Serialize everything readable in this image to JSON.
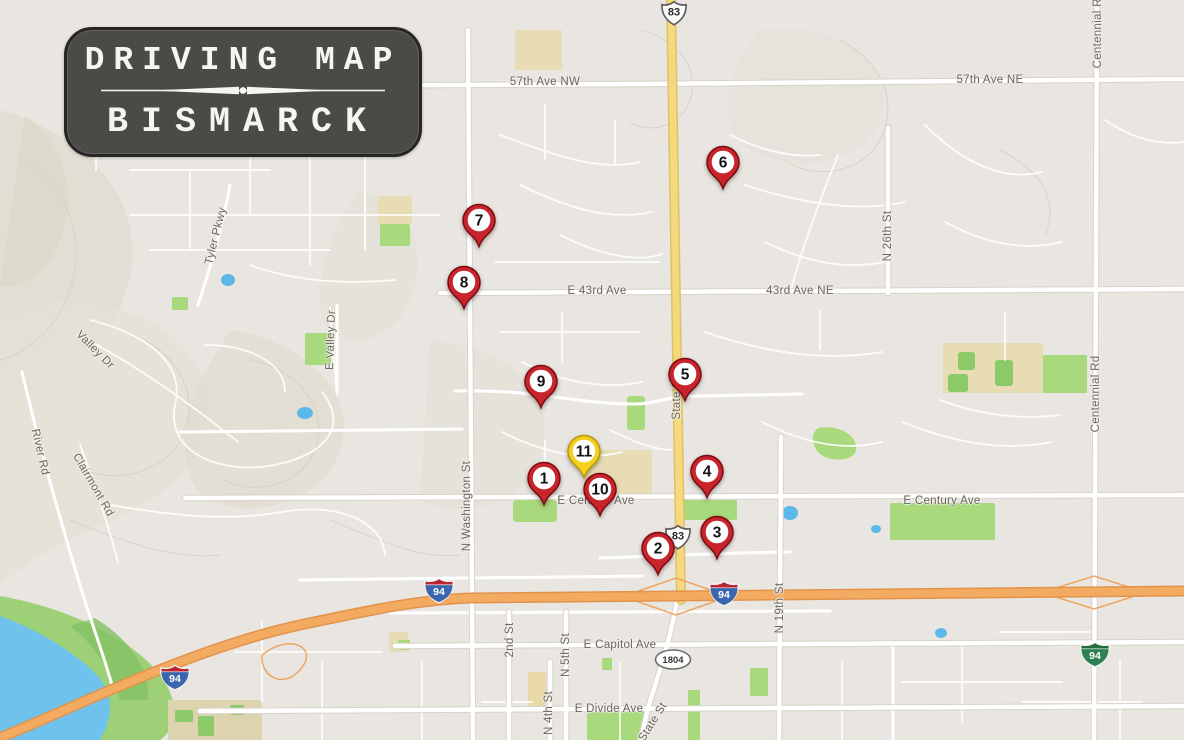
{
  "title_badge": {
    "line1": "DRIVING MAP",
    "line2": "BISMARCK"
  },
  "colors": {
    "background": "#e9e6e1",
    "marker_red": "#c8242c",
    "marker_red_border": "#7d0c12",
    "marker_yellow": "#f3cf1e",
    "marker_yellow_border": "#b8990a",
    "highway_orange": "#f3aa61",
    "route_yellow": "#f6d87d",
    "park_green": "#a8d97c",
    "field_green": "#8cc968",
    "campus_beige": "#e7dcb4",
    "water_blue": "#6ec2ec",
    "road_white": "#ffffff",
    "label_gray": "#6a655e"
  },
  "markers": [
    {
      "number": "1",
      "x": 544,
      "y": 478,
      "variant": "red"
    },
    {
      "number": "2",
      "x": 658,
      "y": 548,
      "variant": "red"
    },
    {
      "number": "3",
      "x": 717,
      "y": 532,
      "variant": "red"
    },
    {
      "number": "4",
      "x": 707,
      "y": 471,
      "variant": "red"
    },
    {
      "number": "5",
      "x": 685,
      "y": 374,
      "variant": "red"
    },
    {
      "number": "6",
      "x": 723,
      "y": 162,
      "variant": "red"
    },
    {
      "number": "7",
      "x": 479,
      "y": 220,
      "variant": "red"
    },
    {
      "number": "8",
      "x": 464,
      "y": 282,
      "variant": "red"
    },
    {
      "number": "9",
      "x": 541,
      "y": 381,
      "variant": "red"
    },
    {
      "number": "10",
      "x": 600,
      "y": 489,
      "variant": "red"
    },
    {
      "number": "11",
      "x": 584,
      "y": 451,
      "variant": "yellow"
    }
  ],
  "road_labels": [
    {
      "text": "57th Ave NW",
      "x": 545,
      "y": 82,
      "rot": 0
    },
    {
      "text": "57th Ave NE",
      "x": 990,
      "y": 80,
      "rot": 0
    },
    {
      "text": "E 43rd Ave",
      "x": 597,
      "y": 291,
      "rot": 0
    },
    {
      "text": "43rd Ave NE",
      "x": 800,
      "y": 291,
      "rot": 0
    },
    {
      "text": "N 26th St",
      "x": 888,
      "y": 236,
      "rot": -90
    },
    {
      "text": "Centennial Rd",
      "x": 1098,
      "y": 30,
      "rot": -90
    },
    {
      "text": "Centennial Rd",
      "x": 1096,
      "y": 394,
      "rot": -90
    },
    {
      "text": "Tyler Pkwy",
      "x": 216,
      "y": 236,
      "rot": -76
    },
    {
      "text": "Valley Dr",
      "x": 95,
      "y": 350,
      "rot": 45
    },
    {
      "text": "E Valley Dr",
      "x": 331,
      "y": 340,
      "rot": -88
    },
    {
      "text": "River Rd",
      "x": 40,
      "y": 452,
      "rot": 77
    },
    {
      "text": "Clairmont Rd",
      "x": 93,
      "y": 485,
      "rot": 60
    },
    {
      "text": "N Washington St",
      "x": 467,
      "y": 506,
      "rot": -90
    },
    {
      "text": "State St",
      "x": 677,
      "y": 398,
      "rot": -90
    },
    {
      "text": "E Century Ave",
      "x": 596,
      "y": 501,
      "rot": 0
    },
    {
      "text": "E Century Ave",
      "x": 942,
      "y": 501,
      "rot": 0
    },
    {
      "text": "N 19th St",
      "x": 780,
      "y": 608,
      "rot": -90
    },
    {
      "text": "2nd St",
      "x": 510,
      "y": 640,
      "rot": -90
    },
    {
      "text": "N 5th St",
      "x": 566,
      "y": 655,
      "rot": -90
    },
    {
      "text": "N 4th St",
      "x": 549,
      "y": 713,
      "rot": -90
    },
    {
      "text": "E Capitol Ave",
      "x": 620,
      "y": 645,
      "rot": 0
    },
    {
      "text": "E Divide Ave",
      "x": 609,
      "y": 709,
      "rot": 0
    },
    {
      "text": "State St",
      "x": 653,
      "y": 722,
      "rot": -58
    }
  ],
  "shields": [
    {
      "type": "us-route",
      "label": "83",
      "x": 674,
      "y": 16
    },
    {
      "type": "us-route",
      "label": "83",
      "x": 678,
      "y": 540
    },
    {
      "type": "interstate",
      "label": "94",
      "x": 439,
      "y": 593
    },
    {
      "type": "interstate",
      "label": "94",
      "x": 724,
      "y": 596
    },
    {
      "type": "interstate",
      "label": "94",
      "x": 175,
      "y": 680
    },
    {
      "type": "interstate-business",
      "label": "94",
      "x": 1095,
      "y": 657
    },
    {
      "type": "state-oval",
      "label": "1804",
      "x": 673,
      "y": 662
    }
  ]
}
